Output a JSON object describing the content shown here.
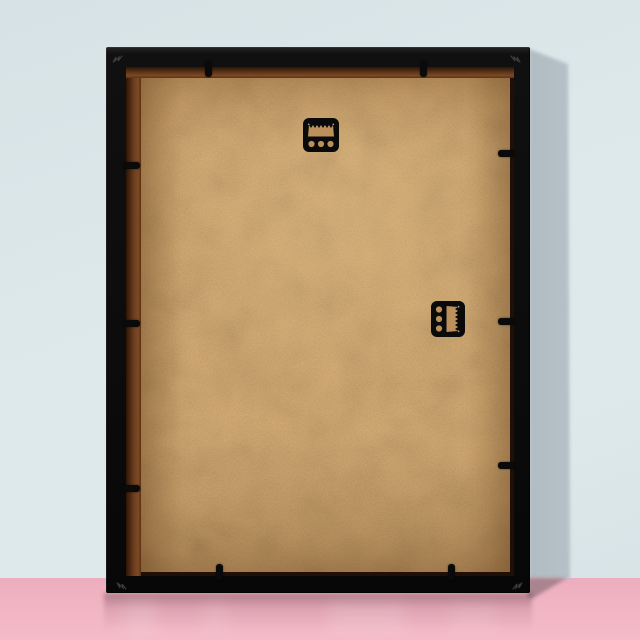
{
  "scene": {
    "subject": "Back of a black picture frame leaning against a wall",
    "wall_label": "pale blue studio wall",
    "floor_label": "glossy pink floor",
    "lighting": "soft light from upper left casting gray shadow to the right of the frame"
  },
  "colors": {
    "wall": "#dde9ea",
    "wall2": "#d6e2e5",
    "wallShadow": "#98a4ab",
    "wallShadowSoft": "#bcc8cd",
    "floor": "#f0b3c2",
    "floorNear": "#edadbe",
    "floorFar": "#f4bbc9",
    "floorShadow": "#a9838f",
    "opening": "#200f04",
    "rabbet": "#7c4a24",
    "board": "#c89d62",
    "boardGrainTint": "#e6c08a",
    "hardware": "#0a0a0a",
    "hole": "#bb905a",
    "glint": "#9a9a9a",
    "vnail": "#4f4f4f"
  },
  "frame": {
    "label": "picture-frame-back",
    "material": "black wooden frame with kraft MDF backing board",
    "corner_joint_marks": 4,
    "tabs": [
      {
        "side": "top",
        "pos": 99
      },
      {
        "side": "top",
        "pos": 314
      },
      {
        "side": "bottom",
        "pos": 110
      },
      {
        "side": "bottom",
        "pos": 342
      },
      {
        "side": "left",
        "pos": 115
      },
      {
        "side": "left",
        "pos": 273
      },
      {
        "side": "left",
        "pos": 438
      },
      {
        "side": "right",
        "pos": 103
      },
      {
        "side": "right",
        "pos": 271
      },
      {
        "side": "right",
        "pos": 415
      }
    ],
    "hangers": [
      {
        "type": "sawtooth-hanger",
        "orientation": "horizontal",
        "screw_holes": 3,
        "position": "top center"
      },
      {
        "type": "sawtooth-hanger",
        "orientation": "vertical",
        "screw_holes": 3,
        "position": "middle right"
      }
    ]
  }
}
